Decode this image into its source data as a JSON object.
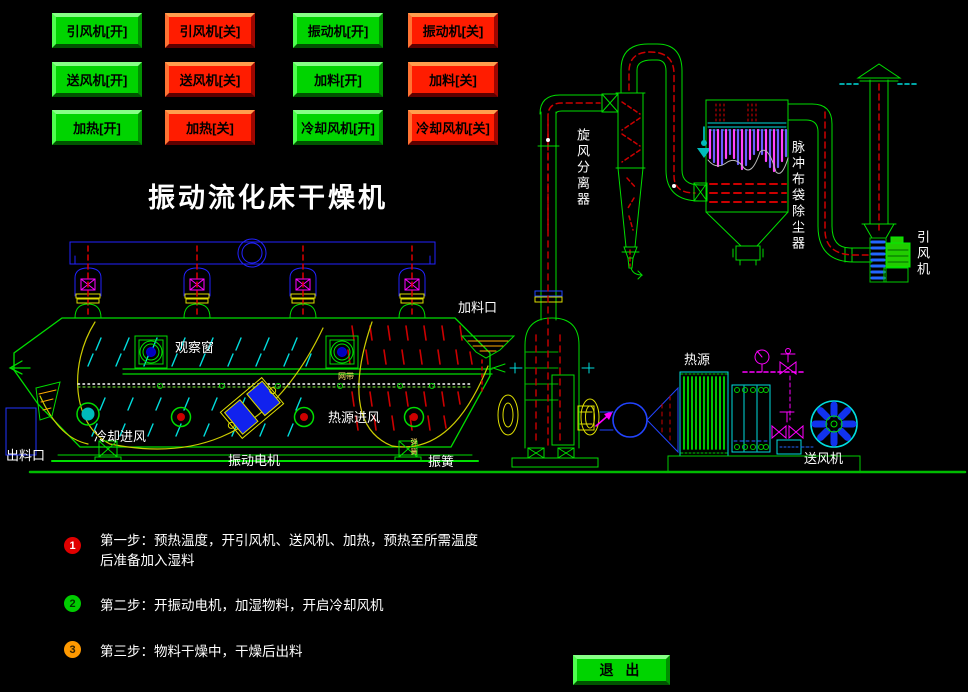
{
  "title": "振动流化床干燥机",
  "palette": {
    "background": "#000000",
    "line_green": "#00ee00",
    "line_blue": "#2222ff",
    "line_cyan": "#00ffff",
    "line_magenta": "#ff00ff",
    "line_red": "#cc0000",
    "line_yellow": "#cccc00",
    "button_on": "#00d400",
    "button_off": "#ff1c00",
    "step1_badge": "#e00000",
    "step2_badge": "#00cc00",
    "step3_badge": "#ff9900",
    "text": "#ffffff"
  },
  "controls": {
    "buttons": [
      {
        "label": "引风机[开]",
        "state": "on"
      },
      {
        "label": "引风机[关]",
        "state": "off"
      },
      {
        "label": "振动机[开]",
        "state": "on"
      },
      {
        "label": "振动机[关]",
        "state": "off"
      },
      {
        "label": "送风机[开]",
        "state": "on"
      },
      {
        "label": "送风机[关]",
        "state": "off"
      },
      {
        "label": "加料[开]",
        "state": "on"
      },
      {
        "label": "加料[关]",
        "state": "off"
      },
      {
        "label": "加热[开]",
        "state": "on"
      },
      {
        "label": "加热[关]",
        "state": "off"
      },
      {
        "label": "冷却风机[开]",
        "state": "on"
      },
      {
        "label": "冷却风机[关]",
        "state": "off"
      }
    ],
    "exit_label": "退 出"
  },
  "diagram": {
    "labels": {
      "feed_port": "加料口",
      "observation_window": "观察窗",
      "heat_air_inlet": "热源进风",
      "cooling_air_inlet": "冷却进风",
      "discharge_port": "出料口",
      "vibration_motor": "振动电机",
      "vibration_spring": "振簧",
      "heat_source": "热源",
      "supply_fan": "送风机",
      "cyclone_separator": "旋风分离器",
      "pulse_bag_filter": "脉冲布袋除尘器",
      "induced_draft_fan": "引风机",
      "mesh_belt": "网带",
      "spring_tiny": "弹簧"
    }
  },
  "steps": [
    {
      "num": "1",
      "text": "第一步：预热温度，开引风机、送风机、加热，预热至所需温度后准备加入湿料"
    },
    {
      "num": "2",
      "text": "第二步：开振动电机，加湿物料，开启冷却风机"
    },
    {
      "num": "3",
      "text": "第三步：物料干燥中，干燥后出料"
    }
  ]
}
